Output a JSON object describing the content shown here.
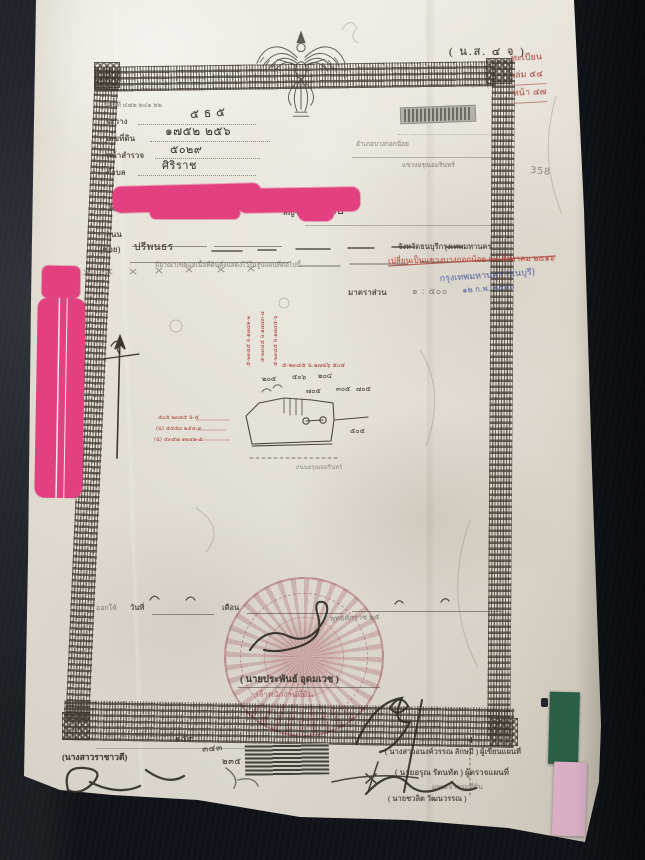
{
  "photo": {
    "background_color": "#171a20",
    "paper_color": "#e6e2d8",
    "subject": "Thai land title deed photographed on dark fabric"
  },
  "colors": {
    "redaction_pink": "#e2407e",
    "seal_red": "#c06070",
    "stamp_red": "#c03d32",
    "stamp_blue": "#3d4f9c",
    "tab_green": "#2a5f47",
    "tab_pink": "#d8afc4"
  },
  "deed": {
    "form_code": "( น.ส. ๔ จ )",
    "registry_red": {
      "line1": "ทะเบียน",
      "line2": "เล่ม  ๕๔",
      "line3": "หน้า  ๔๗"
    },
    "pencil_page_number": "358",
    "header_fields": {
      "serial_faint": "เลขที่  ๔๗๒   ๒๔๑   ๒๒",
      "rawang_label": "ระวาง",
      "rawang_value": "๕ ธ ๕",
      "land_no_label": "เลขที่ดิน",
      "land_no_value": "๑๗๕๒   ๒๕๖",
      "survey_page_label": "หน้าสำรวจ",
      "survey_page_value": "๕๐๒๙",
      "tambon_label": "ตำบล",
      "tambon_value": "ศิริราช",
      "tambon_faint": "แขวงอรุณอมรินทร์",
      "amphoe_label": "อำเภอบางกอกน้อย",
      "province_print": "จังหวัดธนบุรีกรุงเทพมหานคร"
    },
    "owner": {
      "intro": "โฉนดที่ดินฉบับนี้ให้ไว้เป็นหลักฐานว่า",
      "nationality_label": "สัญชาติ",
      "nationality_value": "ไทย",
      "road_label": "ถนน",
      "soi_label": "(ซอย)",
      "soi_value": "ปรีพนธร"
    },
    "body": {
      "boundary_note": "มีอาณาเขตแลเนื้อที่ดินดั่งแสดงไว้ในรูปแผนที่ต่อไปนี้",
      "scale_label": "มาตราส่วน",
      "scale_value": "๑ : ๕๐๐"
    },
    "overstamps": {
      "red_line": "เปลี่ยนเป็นแขวงบางกอกน้อย ๒๑ สิงหาคม ๒๕๑๖",
      "blue_line1": "กรุงเทพมหานคร (ธนบุรี)",
      "blue_line2": "๑๒ ก.พ. ๒๕๑๖"
    },
    "sketch": {
      "red_vertical_1": "๕-๒๓๔๕ ฉ.๑๗๔๑-๒",
      "red_vertical_2": "๕-๒๓๔๕ ฉ.๑๗๔๓-๔",
      "red_vertical_3": "๕-๒๓๔๕ ฉ.๑๗๔๕-๖",
      "red_right": "๕-๒๓๔๕ ฉ.๑๗๔๖  ๕๐๕",
      "red_left_1": "๕๐๕ ๒๓๔๕ ฉ-๕",
      "red_left_2": "(ฉ) ๕๕๕๓ ๒๕๔-๓",
      "red_left_3": "(ฉ) ๕๓๕๗ ๑๒๔๑-๕",
      "parcels": [
        "๒๐๕",
        "๕๐๖",
        "๒๐๔",
        "๗๐๕",
        "๓๐๕",
        "๗๐๕",
        "๕๐๕"
      ],
      "road_note": "ถนนอรุณอมรินทร์"
    },
    "issue": {
      "issued_label": "ออกให้",
      "date_label": "วันที่",
      "month_label": "เดือน",
      "era_label": "พุทธศักราช ๒๕"
    },
    "seal": {
      "signer": "( นายประพันธ์  อุดมเวช )",
      "title": "เจ้าพนักงานที่ดิน"
    },
    "footer": {
      "left_print": "นางสาวอาภรณ์โฉม  อินทร์งาม",
      "left_name": "(นางสาวราชาวดี)",
      "hand_number_1": "๑๕๓",
      "hand_number_2": "๓๔๓",
      "hand_number_3": "๒๓๕",
      "right_line1_name": "( นางสาวอนงค์วรรณ  ลักษมี )",
      "right_line1_role": "ผู้เขียนแผนที่",
      "right_line1_sup": "4",
      "right_line2_name": "( นายอรุณ  รัตนทัต )",
      "right_line2_role": "ผู้ตรวจแผนที่",
      "right_line3": "แทนเจ้ากรมที่ดิน",
      "right_line4": "( นายชวลิต  วัฒนวรรณ )"
    }
  }
}
